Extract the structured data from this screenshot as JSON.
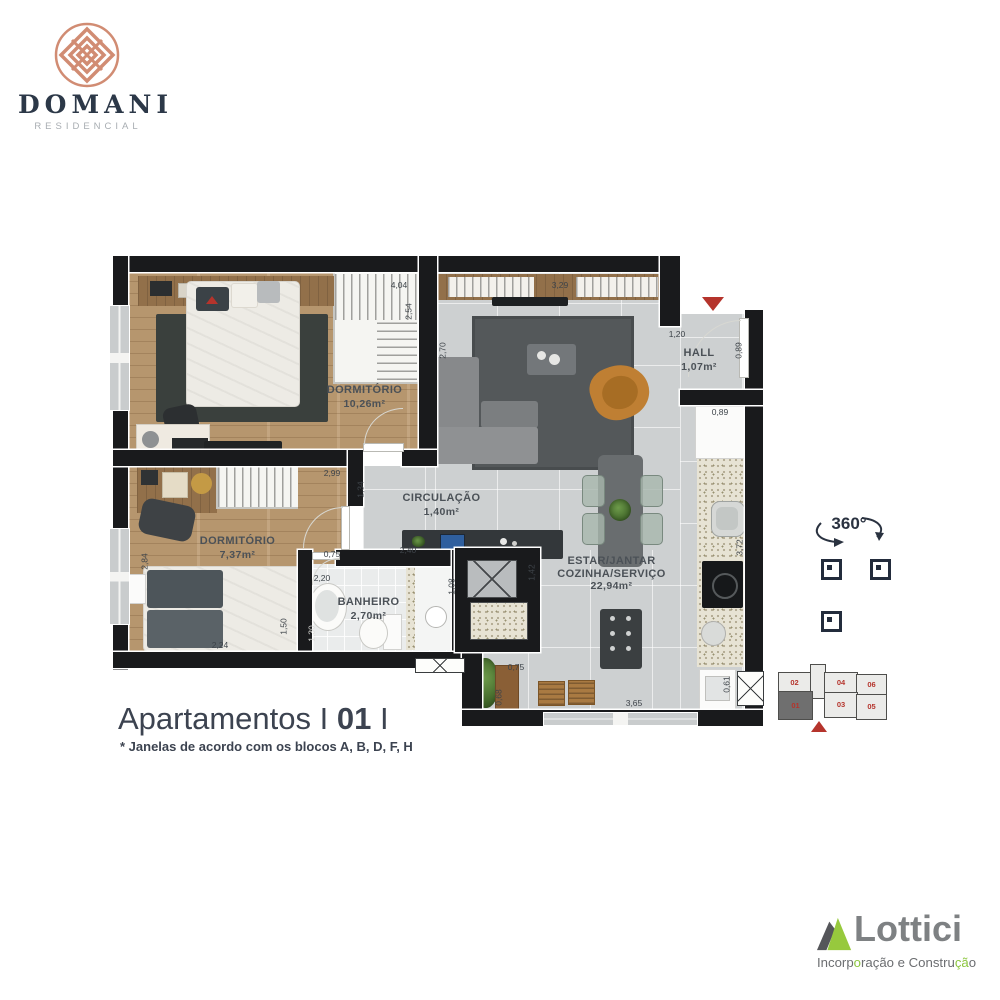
{
  "brand": {
    "name": "DOMANI",
    "subtitle": "RESIDENCIAL"
  },
  "floorplan": {
    "rooms": [
      {
        "name": "DORMITÓRIO",
        "area": "10,26m²"
      },
      {
        "name": "DORMITÓRIO",
        "area": "7,37m²"
      },
      {
        "name": "BANHEIRO",
        "area": "2,70m²"
      },
      {
        "name": "CIRCULAÇÃO",
        "area": "1,40m²"
      },
      {
        "name": "ESTAR/JANTAR",
        "name2": "COZINHA/SERVIÇO",
        "area": "22,94m²"
      },
      {
        "name": "HALL",
        "area": "1,07m²"
      }
    ],
    "dimensions": {
      "w404": "4,04",
      "h254": "2,54",
      "w329": "3,29",
      "h270": "2,70",
      "w120": "1,20",
      "h089": "0,89",
      "w089": "0,89",
      "w299": "2,99",
      "h134": "1,34",
      "h284": "2,84",
      "w075a": "0,75",
      "w240": "2,40",
      "w220": "2,20",
      "h130": "1,30",
      "h150": "1,50",
      "w224": "2,24",
      "h108": "1,08",
      "h142": "1,42",
      "h372": "3,72",
      "w075b": "0,75",
      "h068": "0,68",
      "w365": "3,65",
      "h061": "0,61"
    }
  },
  "viewer": {
    "label": "360°"
  },
  "unit_map": {
    "top_row": [
      "02",
      "04",
      "06"
    ],
    "bottom_row": [
      "01",
      "03",
      "05"
    ],
    "selected": "01"
  },
  "title": {
    "prefix": "Apartamentos",
    "sep_left": "I",
    "number": "01",
    "sep_right": "I"
  },
  "footnote": "* Janelas de acordo com os blocos A, B, D, F, H",
  "builder": {
    "name": "Lottici",
    "tagline": [
      {
        "t": "Incorp"
      },
      {
        "t": "o"
      },
      {
        "t": "ração e Constru"
      },
      {
        "t": "çã"
      },
      {
        "t": "o"
      }
    ]
  },
  "colors": {
    "accent_red": "#b5342c",
    "brand_rose": "#d18c73",
    "navy": "#2c3848",
    "builder_green": "#8cc63e",
    "builder_gray": "#7e8183",
    "wall_black": "#191a1c"
  }
}
